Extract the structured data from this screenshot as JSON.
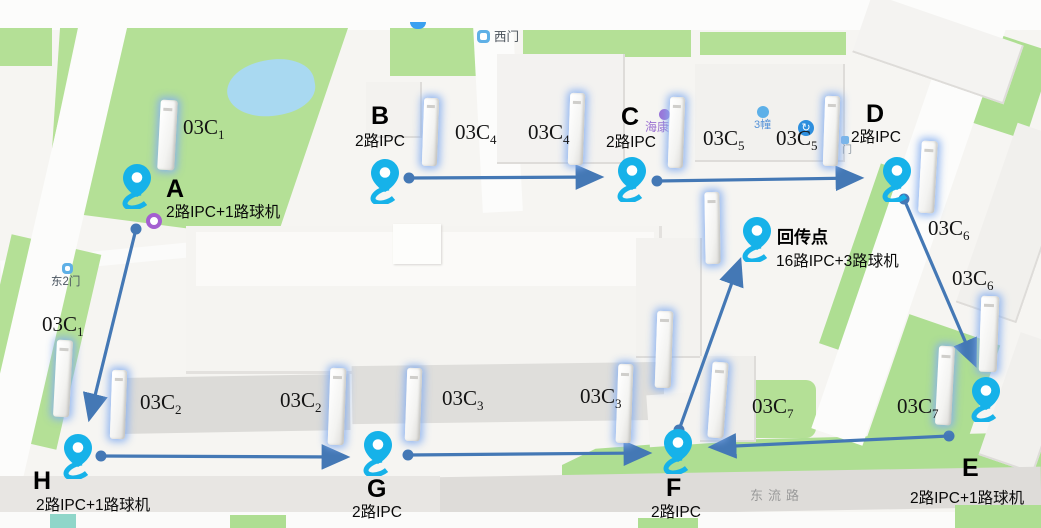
{
  "map_labels": {
    "west_gate": "西门",
    "east_gate_2": "东2门",
    "haikang": "海康",
    "building_3": "3幢",
    "gate_door": "门",
    "dongliu_road": "东流路"
  },
  "icons": {
    "poi_arrow": "↻"
  },
  "points": {
    "A": {
      "letter": "A",
      "desc": "2路IPC+1路球机"
    },
    "B": {
      "letter": "B",
      "desc": "2路IPC"
    },
    "C": {
      "letter": "C",
      "desc": "2路IPC"
    },
    "D": {
      "letter": "D",
      "desc": "2路IPC"
    },
    "E": {
      "letter": "E",
      "desc": "2路IPC+1路球机"
    },
    "F": {
      "letter": "F",
      "desc": "2路IPC"
    },
    "G": {
      "letter": "G",
      "desc": "2路IPC"
    },
    "H": {
      "letter": "H",
      "desc": "2路IPC+1路球机"
    },
    "relay": {
      "letter": "回传点",
      "desc": "16路IPC+3路球机"
    }
  },
  "devices": [
    {
      "base": "03C",
      "sub": "1"
    },
    {
      "base": "03C",
      "sub": "4"
    },
    {
      "base": "03C",
      "sub": "4"
    },
    {
      "base": "03C",
      "sub": "5"
    },
    {
      "base": "03C",
      "sub": "5"
    },
    {
      "base": "03C",
      "sub": "6"
    },
    {
      "base": "03C",
      "sub": "6"
    },
    {
      "base": "03C",
      "sub": "1"
    },
    {
      "base": "03C",
      "sub": "2"
    },
    {
      "base": "03C",
      "sub": "2"
    },
    {
      "base": "03C",
      "sub": "3"
    },
    {
      "base": "03C",
      "sub": "3"
    },
    {
      "base": "03C",
      "sub": "7"
    },
    {
      "base": "03C",
      "sub": "7"
    }
  ],
  "colors": {
    "pin": "#16b2e9",
    "arrow": "#4478b5",
    "pole_glow": "#85aef0",
    "park_green": "#b4e096"
  }
}
